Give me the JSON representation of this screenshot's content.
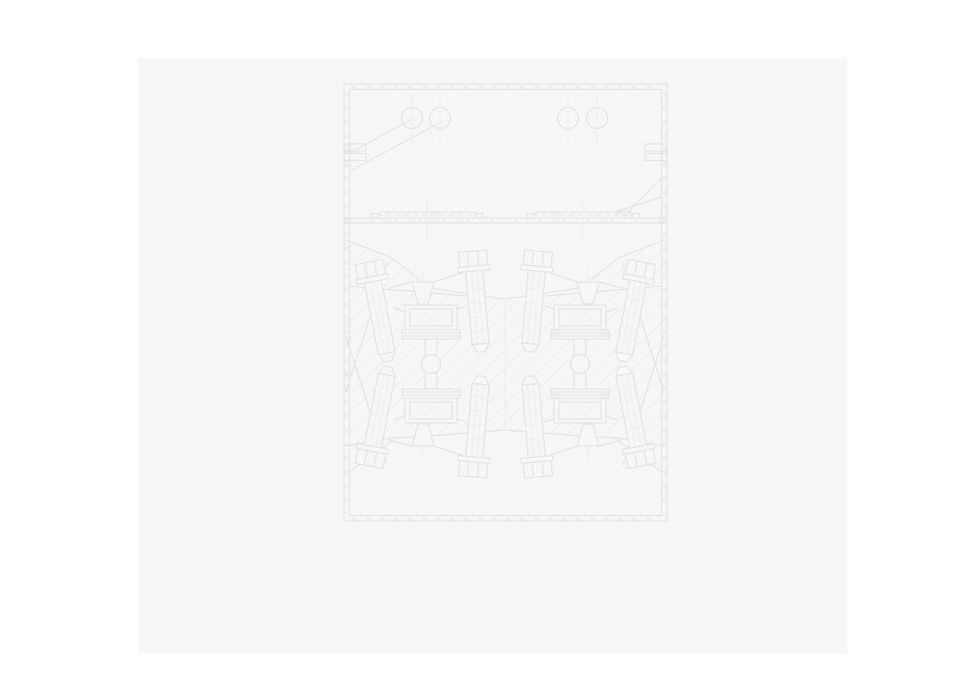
{
  "window": {
    "width": 961,
    "height": 694,
    "background_color": "#ffffff"
  },
  "page": {
    "description": "blank drawing sheet with faint engineering CAD drawing, no visible text",
    "x": 138,
    "y": 58,
    "width": 709,
    "height": 595,
    "color": "#f6f6f6"
  },
  "drawing": {
    "line_color": "#e2e2e2",
    "light_line_color": "#ededed",
    "hatch_color": "#ececec",
    "fill_color": "#f6f6f6",
    "defs": {
      "bolt": [
        {
          "t": "rect",
          "x": -14,
          "y": -52,
          "w": 28,
          "h": 15,
          "c": "s f",
          "name": "bolt-head"
        },
        {
          "t": "line",
          "x1": -5,
          "y1": -52,
          "x2": -5,
          "y2": -37,
          "c": "s",
          "name": "bolt-head-facet"
        },
        {
          "t": "line",
          "x1": 5,
          "y1": -52,
          "x2": 5,
          "y2": -37,
          "c": "s",
          "name": "bolt-head-facet"
        },
        {
          "t": "rect",
          "x": -16,
          "y": -37,
          "w": 32,
          "h": 5,
          "c": "s f",
          "name": "bolt-collar"
        },
        {
          "t": "rect",
          "x": -8.5,
          "y": -32,
          "w": 17,
          "h": 73,
          "c": "s f",
          "name": "bolt-shaft"
        },
        {
          "t": "line",
          "x1": -3,
          "y1": -32,
          "x2": -3,
          "y2": 41,
          "c": "sl",
          "name": "shaft-line"
        },
        {
          "t": "line",
          "x1": 3,
          "y1": -32,
          "x2": 3,
          "y2": 41,
          "c": "sl",
          "name": "shaft-line"
        },
        {
          "t": "line",
          "x1": -8.5,
          "y1": -14,
          "x2": 8.5,
          "y2": -14,
          "c": "sl",
          "name": "shaft-tick"
        },
        {
          "t": "line",
          "x1": -8.5,
          "y1": 0,
          "x2": 8.5,
          "y2": 0,
          "c": "sl",
          "name": "shaft-tick"
        },
        {
          "t": "line",
          "x1": -8.5,
          "y1": 14,
          "x2": 8.5,
          "y2": 14,
          "c": "sl",
          "name": "shaft-tick"
        },
        {
          "t": "line",
          "x1": -8.5,
          "y1": 28,
          "x2": 8.5,
          "y2": 28,
          "c": "sl",
          "name": "shaft-tick"
        },
        {
          "t": "poly",
          "pts": "-8.5,41 8.5,41 4,49 -4,49",
          "c": "s f",
          "name": "bolt-tip"
        }
      ],
      "rail": [
        {
          "t": "polyline",
          "pts": "-57,6 -46,0 46,0 57,6",
          "c": "s",
          "name": "rail-profile"
        },
        {
          "t": "line",
          "x1": -50,
          "y1": 3,
          "x2": 50,
          "y2": 3,
          "c": "s dash",
          "name": "rail-midline"
        },
        {
          "t": "line",
          "x1": -36,
          "y1": 0,
          "x2": -36,
          "y2": 6,
          "c": "sl",
          "name": "rail-seg"
        },
        {
          "t": "line",
          "x1": -24,
          "y1": 0,
          "x2": -24,
          "y2": 6,
          "c": "sl",
          "name": "rail-seg"
        },
        {
          "t": "line",
          "x1": -12,
          "y1": 0,
          "x2": -12,
          "y2": 6,
          "c": "sl",
          "name": "rail-seg"
        },
        {
          "t": "line",
          "x1": 0,
          "y1": 0,
          "x2": 0,
          "y2": 6,
          "c": "sl",
          "name": "rail-seg"
        },
        {
          "t": "line",
          "x1": 12,
          "y1": 0,
          "x2": 12,
          "y2": 6,
          "c": "sl",
          "name": "rail-seg"
        },
        {
          "t": "line",
          "x1": 24,
          "y1": 0,
          "x2": 24,
          "y2": 6,
          "c": "sl",
          "name": "rail-seg"
        },
        {
          "t": "line",
          "x1": 36,
          "y1": 0,
          "x2": 36,
          "y2": 6,
          "c": "sl",
          "name": "rail-seg"
        },
        {
          "t": "rect",
          "x": -56,
          "y": 1.5,
          "w": 7,
          "h": 4.5,
          "c": "sd f",
          "name": "rail-end-nub"
        },
        {
          "t": "rect",
          "x": 49,
          "y": 1.5,
          "w": 7,
          "h": 4.5,
          "c": "sd f",
          "name": "rail-end-nub"
        },
        {
          "t": "line",
          "x1": 0,
          "y1": -14,
          "x2": 0,
          "y2": 28,
          "c": "sl",
          "name": "rail-centerline"
        }
      ],
      "assembly": [
        {
          "t": "line",
          "x1": 389,
          "y1": 288,
          "x2": 412,
          "y2": 282,
          "c": "s",
          "name": "yoke-line"
        },
        {
          "t": "line",
          "x1": 461,
          "y1": 273,
          "x2": 434,
          "y2": 282,
          "c": "s",
          "name": "yoke-line"
        },
        {
          "t": "line",
          "x1": 423,
          "y1": 268,
          "x2": 423,
          "y2": 312,
          "c": "sl",
          "name": "funnel-centerline"
        },
        {
          "t": "poly",
          "pts": "412,282 434,282 428,304 418,304",
          "c": "s f",
          "name": "funnel"
        },
        {
          "t": "line",
          "x1": 405,
          "y1": 312,
          "x2": 394,
          "y2": 308,
          "c": "s",
          "name": "arm-line"
        },
        {
          "t": "line",
          "x1": 457,
          "y1": 309,
          "x2": 466,
          "y2": 306,
          "c": "s",
          "name": "arm-line"
        },
        {
          "t": "ref",
          "d": "bolt",
          "tf": "translate(379,313) rotate(-11)",
          "name": "clamp-bolt-outer"
        },
        {
          "t": "ref",
          "d": "bolt",
          "tf": "translate(477,303) rotate(-5)",
          "name": "clamp-bolt-inner"
        },
        {
          "t": "rect",
          "x": 405,
          "y": 305,
          "w": 52,
          "h": 25,
          "c": "s f",
          "name": "die-block"
        },
        {
          "t": "rect",
          "x": 410,
          "y": 309,
          "w": 42,
          "h": 17,
          "c": "s",
          "name": "die-block-inner"
        },
        {
          "t": "line",
          "x1": 416,
          "y1": 322,
          "x2": 428,
          "y2": 312,
          "c": "sl",
          "name": "block-hatch"
        },
        {
          "t": "line",
          "x1": 424,
          "y1": 324,
          "x2": 436,
          "y2": 314,
          "c": "sl",
          "name": "block-hatch"
        },
        {
          "t": "line",
          "x1": 432,
          "y1": 325,
          "x2": 444,
          "y2": 315,
          "c": "sl",
          "name": "block-hatch"
        },
        {
          "t": "rect",
          "x": 402,
          "y": 330,
          "w": 58,
          "h": 9,
          "c": "s f",
          "name": "plate-stack"
        },
        {
          "t": "line",
          "x1": 402,
          "y1": 333,
          "x2": 460,
          "y2": 333,
          "c": "s",
          "name": "plate-line"
        },
        {
          "t": "line",
          "x1": 402,
          "y1": 336,
          "x2": 460,
          "y2": 336,
          "c": "s",
          "name": "plate-line"
        },
        {
          "t": "rect",
          "x": 425,
          "y": 339,
          "w": 12,
          "h": 16,
          "c": "s f",
          "name": "pivot-stem"
        }
      ]
    },
    "scene": [
      {
        "t": "rect",
        "x": 138,
        "y": 58,
        "w": 709,
        "h": 595,
        "c": "pagefill",
        "name": "document-page"
      },
      {
        "t": "rect",
        "x": 344,
        "y": 84,
        "w": 323,
        "h": 437,
        "c": "s",
        "name": "frame-outer"
      },
      {
        "t": "rect",
        "x": 349.5,
        "y": 89.5,
        "w": 312,
        "h": 426,
        "c": "s",
        "name": "frame-inner"
      },
      {
        "t": "line",
        "x1": 352,
        "y1": 87,
        "x2": 659,
        "y2": 87,
        "c": "ticks",
        "name": "frame-ticks-top"
      },
      {
        "t": "line",
        "x1": 352,
        "y1": 518.5,
        "x2": 659,
        "y2": 518.5,
        "c": "ticks",
        "name": "frame-ticks-bottom"
      },
      {
        "t": "line",
        "x1": 346.5,
        "y1": 92,
        "x2": 346.5,
        "y2": 513,
        "c": "ticks",
        "name": "frame-ticks-left"
      },
      {
        "t": "line",
        "x1": 664.5,
        "y1": 92,
        "x2": 664.5,
        "y2": 513,
        "c": "ticks",
        "name": "frame-ticks-right"
      },
      {
        "t": "circle",
        "cx": 412,
        "cy": 118,
        "r": 10.5,
        "c": "s",
        "name": "hole-circle"
      },
      {
        "t": "circle",
        "cx": 440,
        "cy": 118,
        "r": 10.5,
        "c": "s",
        "name": "hole-circle"
      },
      {
        "t": "circle",
        "cx": 568,
        "cy": 118,
        "r": 10.5,
        "c": "s",
        "name": "hole-circle"
      },
      {
        "t": "circle",
        "cx": 597,
        "cy": 118,
        "r": 10.5,
        "c": "s",
        "name": "hole-circle"
      },
      {
        "t": "line",
        "x1": 412,
        "y1": 93,
        "x2": 412,
        "y2": 145,
        "c": "sl",
        "name": "hole-centerline"
      },
      {
        "t": "line",
        "x1": 440,
        "y1": 93,
        "x2": 440,
        "y2": 145,
        "c": "sl",
        "name": "hole-centerline"
      },
      {
        "t": "line",
        "x1": 568,
        "y1": 93,
        "x2": 568,
        "y2": 145,
        "c": "sl",
        "name": "hole-centerline"
      },
      {
        "t": "line",
        "x1": 597,
        "y1": 93,
        "x2": 597,
        "y2": 145,
        "c": "sl",
        "name": "hole-centerline"
      },
      {
        "t": "rect",
        "x": 344,
        "y": 144,
        "w": 22,
        "h": 7,
        "c": "s",
        "name": "wall-tab"
      },
      {
        "t": "rect",
        "x": 344,
        "y": 153.5,
        "w": 22,
        "h": 7,
        "c": "s",
        "name": "wall-tab"
      },
      {
        "t": "rect",
        "x": 645,
        "y": 144,
        "w": 22,
        "h": 7,
        "c": "s",
        "name": "wall-tab"
      },
      {
        "t": "rect",
        "x": 645,
        "y": 153.5,
        "w": 22,
        "h": 7,
        "c": "s",
        "name": "wall-tab"
      },
      {
        "t": "line",
        "x1": 350,
        "y1": 153,
        "x2": 412,
        "y2": 119,
        "c": "s",
        "name": "leader-line"
      },
      {
        "t": "line",
        "x1": 350,
        "y1": 171,
        "x2": 441,
        "y2": 122,
        "c": "s",
        "name": "leader-line"
      },
      {
        "t": "line",
        "x1": 628,
        "y1": 212,
        "x2": 661,
        "y2": 178,
        "c": "s",
        "name": "leader-line"
      },
      {
        "t": "line",
        "x1": 616,
        "y1": 212,
        "x2": 661,
        "y2": 197,
        "c": "s",
        "name": "leader-line"
      },
      {
        "t": "line",
        "x1": 344,
        "y1": 218,
        "x2": 667,
        "y2": 218,
        "c": "s",
        "name": "divider-top"
      },
      {
        "t": "line",
        "x1": 344,
        "y1": 223,
        "x2": 667,
        "y2": 223,
        "c": "s",
        "name": "divider-bottom"
      },
      {
        "t": "line",
        "x1": 346,
        "y1": 220.5,
        "x2": 665,
        "y2": 220.5,
        "c": "ticks2",
        "name": "divider-ticks"
      },
      {
        "t": "ref",
        "d": "rail",
        "tf": "translate(427,212)",
        "name": "rail-left"
      },
      {
        "t": "ref",
        "d": "rail",
        "tf": "translate(583,212)",
        "name": "rail-right"
      },
      {
        "t": "poly",
        "pts": "346,240 392,258 430,288 505,299 580,288 618,258 664,240 664,446 618,438 580,436 505,430 430,436 392,438 346,446",
        "fill": "url(#hatch)",
        "name": "hatched-mass"
      },
      {
        "t": "polyline",
        "pts": "346,240 392,258 430,288 505,299 580,288 618,258 664,240",
        "c": "s",
        "name": "mass-top-boundary"
      },
      {
        "t": "polyline",
        "pts": "346,446 392,438 430,436 505,430 580,436 618,438 664,446",
        "c": "s",
        "name": "mass-bottom-boundary"
      },
      {
        "t": "line",
        "x1": 505,
        "y1": 299,
        "x2": 505,
        "y2": 430,
        "c": "sl",
        "name": "center-seam"
      },
      {
        "t": "line",
        "x1": 349,
        "y1": 286,
        "x2": 466,
        "y2": 296,
        "c": "s",
        "name": "leader-line"
      },
      {
        "t": "line",
        "x1": 662,
        "y1": 286,
        "x2": 545,
        "y2": 296,
        "c": "s",
        "name": "leader-line"
      },
      {
        "t": "line",
        "x1": 346,
        "y1": 392,
        "x2": 387,
        "y2": 263,
        "c": "s",
        "name": "leader-line"
      },
      {
        "t": "line",
        "x1": 664,
        "y1": 392,
        "x2": 623,
        "y2": 263,
        "c": "s",
        "name": "leader-line"
      },
      {
        "t": "line",
        "x1": 346,
        "y1": 336,
        "x2": 387,
        "y2": 465,
        "c": "s",
        "name": "leader-line"
      },
      {
        "t": "line",
        "x1": 664,
        "y1": 336,
        "x2": 623,
        "y2": 465,
        "c": "s",
        "name": "leader-line"
      },
      {
        "t": "line",
        "x1": 349,
        "y1": 472,
        "x2": 398,
        "y2": 437,
        "c": "s",
        "name": "leader-line"
      },
      {
        "t": "line",
        "x1": 662,
        "y1": 472,
        "x2": 613,
        "y2": 437,
        "c": "s",
        "name": "leader-line"
      },
      {
        "t": "ref",
        "d": "assembly",
        "name": "clamp-assembly-upper-left"
      },
      {
        "t": "ref",
        "d": "assembly",
        "tf": "translate(0,728) scale(1,-1)",
        "name": "clamp-assembly-lower-left"
      },
      {
        "t": "ref",
        "d": "assembly",
        "tf": "translate(1011,0) scale(-1,1)",
        "name": "clamp-assembly-upper-right"
      },
      {
        "t": "ref",
        "d": "assembly",
        "tf": "translate(1011,728) scale(-1,-1)",
        "name": "clamp-assembly-lower-right"
      },
      {
        "t": "circle",
        "cx": 431,
        "cy": 364,
        "r": 9.5,
        "c": "s f",
        "name": "pivot-circle"
      },
      {
        "t": "circle",
        "cx": 580,
        "cy": 364,
        "r": 9.5,
        "c": "s f",
        "name": "pivot-circle"
      }
    ]
  }
}
